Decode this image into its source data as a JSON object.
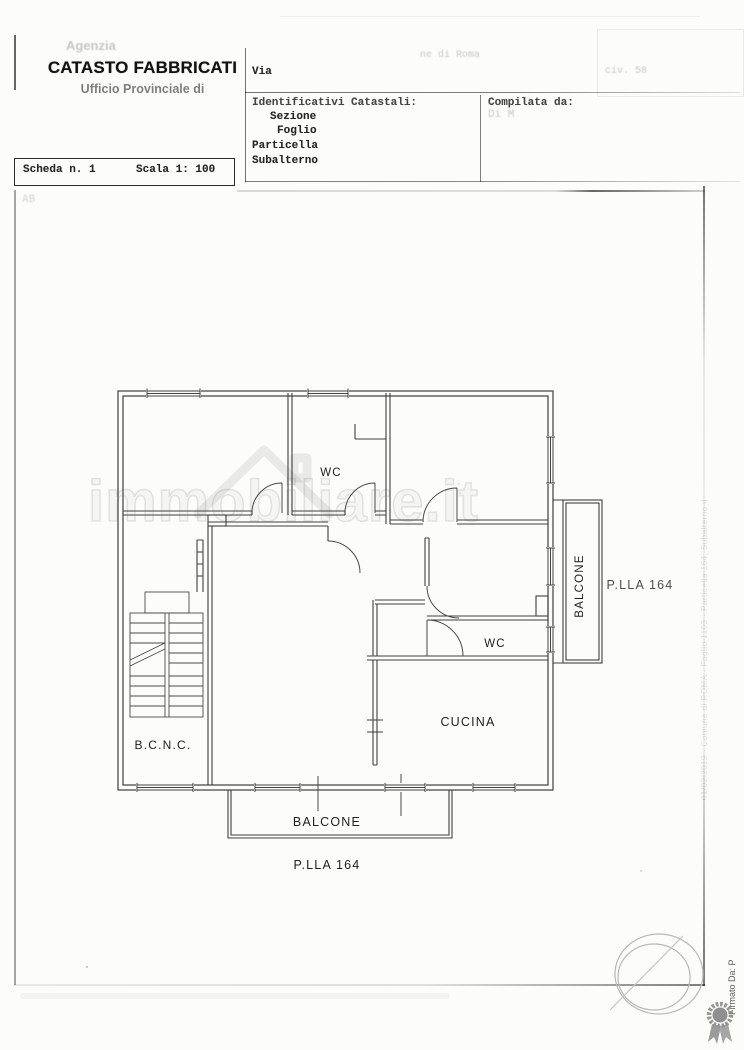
{
  "header": {
    "agency_faint": "Agenzia",
    "title": "CATASTO FABBRICATI",
    "subtitle": "Ufficio Provinciale di",
    "comune_faint": "ne di Roma",
    "via_label": "Via",
    "civ_faint": "civ. 58",
    "identificativi": {
      "heading": "Identificativi Catastali:",
      "row1": "Sezione",
      "row2": "Foglio",
      "row3": "Particella",
      "row4": "Subalterno"
    },
    "compilata_heading": "Compilata da:",
    "compilata_faint": "Di M",
    "scheda": "Scheda n. 1",
    "scala": "Scala 1: 100",
    "faint_note": "AB"
  },
  "plan": {
    "labels": {
      "wc_top": "WC",
      "wc_middle": "WC",
      "cucina": "CUCINA",
      "bcnc": "B.C.N.C.",
      "balcone_bottom": "BALCONE",
      "balcone_right": "BALCONE",
      "plla_right": "P.LLA 164",
      "plla_bottom": "P.LLA 164"
    }
  },
  "watermark": "immobiliare.it",
  "margin": {
    "side_text": "01/02/2019 - Comune di ROMA - Foglio 1103 - Particella 164, Subalterno 4",
    "firmato": "Firmato Da: P"
  },
  "colors": {
    "ink": "#262626",
    "paper": "#fcfcfa",
    "stamp": "#b8b8b8"
  }
}
